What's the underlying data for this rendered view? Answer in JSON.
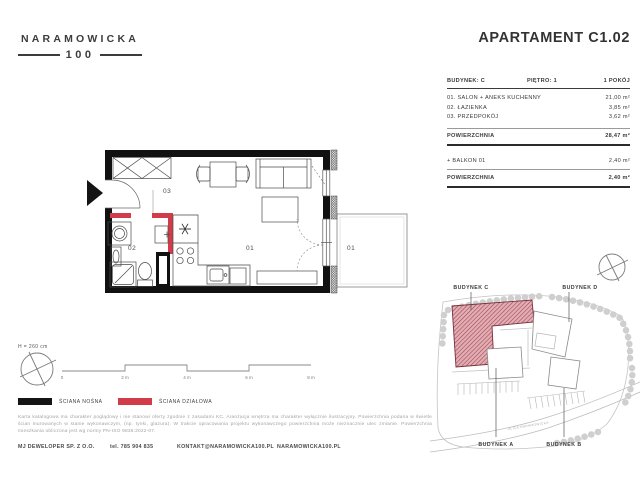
{
  "brand": {
    "name": "NARAMOWICKA",
    "number": "100"
  },
  "header": {
    "title": "APARTAMENT C1.02"
  },
  "unit_table": {
    "building": "BUDYNEK: C",
    "floor": "PIĘTRO: 1",
    "rooms_count": "1 POKÓJ",
    "rooms": [
      {
        "label": "01. SALON + ANEKS KUCHENNY",
        "area": "21,00 m²"
      },
      {
        "label": "02. ŁAZIENKA",
        "area": "3,85 m²"
      },
      {
        "label": "03. PRZEDPOKÓJ",
        "area": "3,62 m²"
      }
    ],
    "total_label": "POWIERZCHNIA",
    "total_area": "28,47 m²",
    "balcony_label": "+ BALKON 01",
    "balcony_area": "2,40 m²",
    "balcony_total_label": "POWIERZCHNIA",
    "balcony_total_area": "2,40 m²"
  },
  "plan": {
    "labels": {
      "living": "01",
      "bathroom": "02",
      "hall": "03",
      "balcony": "01"
    },
    "height_note": "H = 260 cm",
    "scale_labels": [
      "0",
      "2 m",
      "4 m",
      "6 m",
      "8 m"
    ],
    "legend": {
      "bearing": {
        "label": "ŚCIANA NOŚNA",
        "color": "#141414"
      },
      "partition": {
        "label": "ŚCIANA DZIAŁOWA",
        "color": "#d23b49"
      }
    }
  },
  "site_plan": {
    "building_a": "BUDYNEK A",
    "building_b": "BUDYNEK B",
    "building_c": "BUDYNEK C",
    "building_d": "BUDYNEK D",
    "street": "ULICA NARAMOWICKA"
  },
  "disclaimer": "Karta katalogowa ma charakter poglądowy i nie stanowi oferty zgodnie z zasadami KC. Aranżacja wnętrza ma charakter wyłącznie ilustracyjny. Powierzchnia podana w świetle ścian murowanych w stanie wykonawczym, (np. tynki, glazura). W trakcie opracowania projektu wykonawczego powierzchnia może nieznacznie ulec zmianie. Powierzchnia mieszkania obliczona jest wg normy PN-ISO 9836:2022-07.",
  "footer": {
    "company": "MJ DEWELOPER SP. Z O.O.",
    "phone": "tel. 785 904 835",
    "email": "KONTAKT@NARAMOWICKA100.PL",
    "website": "NARAMOWICKA100.PL"
  }
}
